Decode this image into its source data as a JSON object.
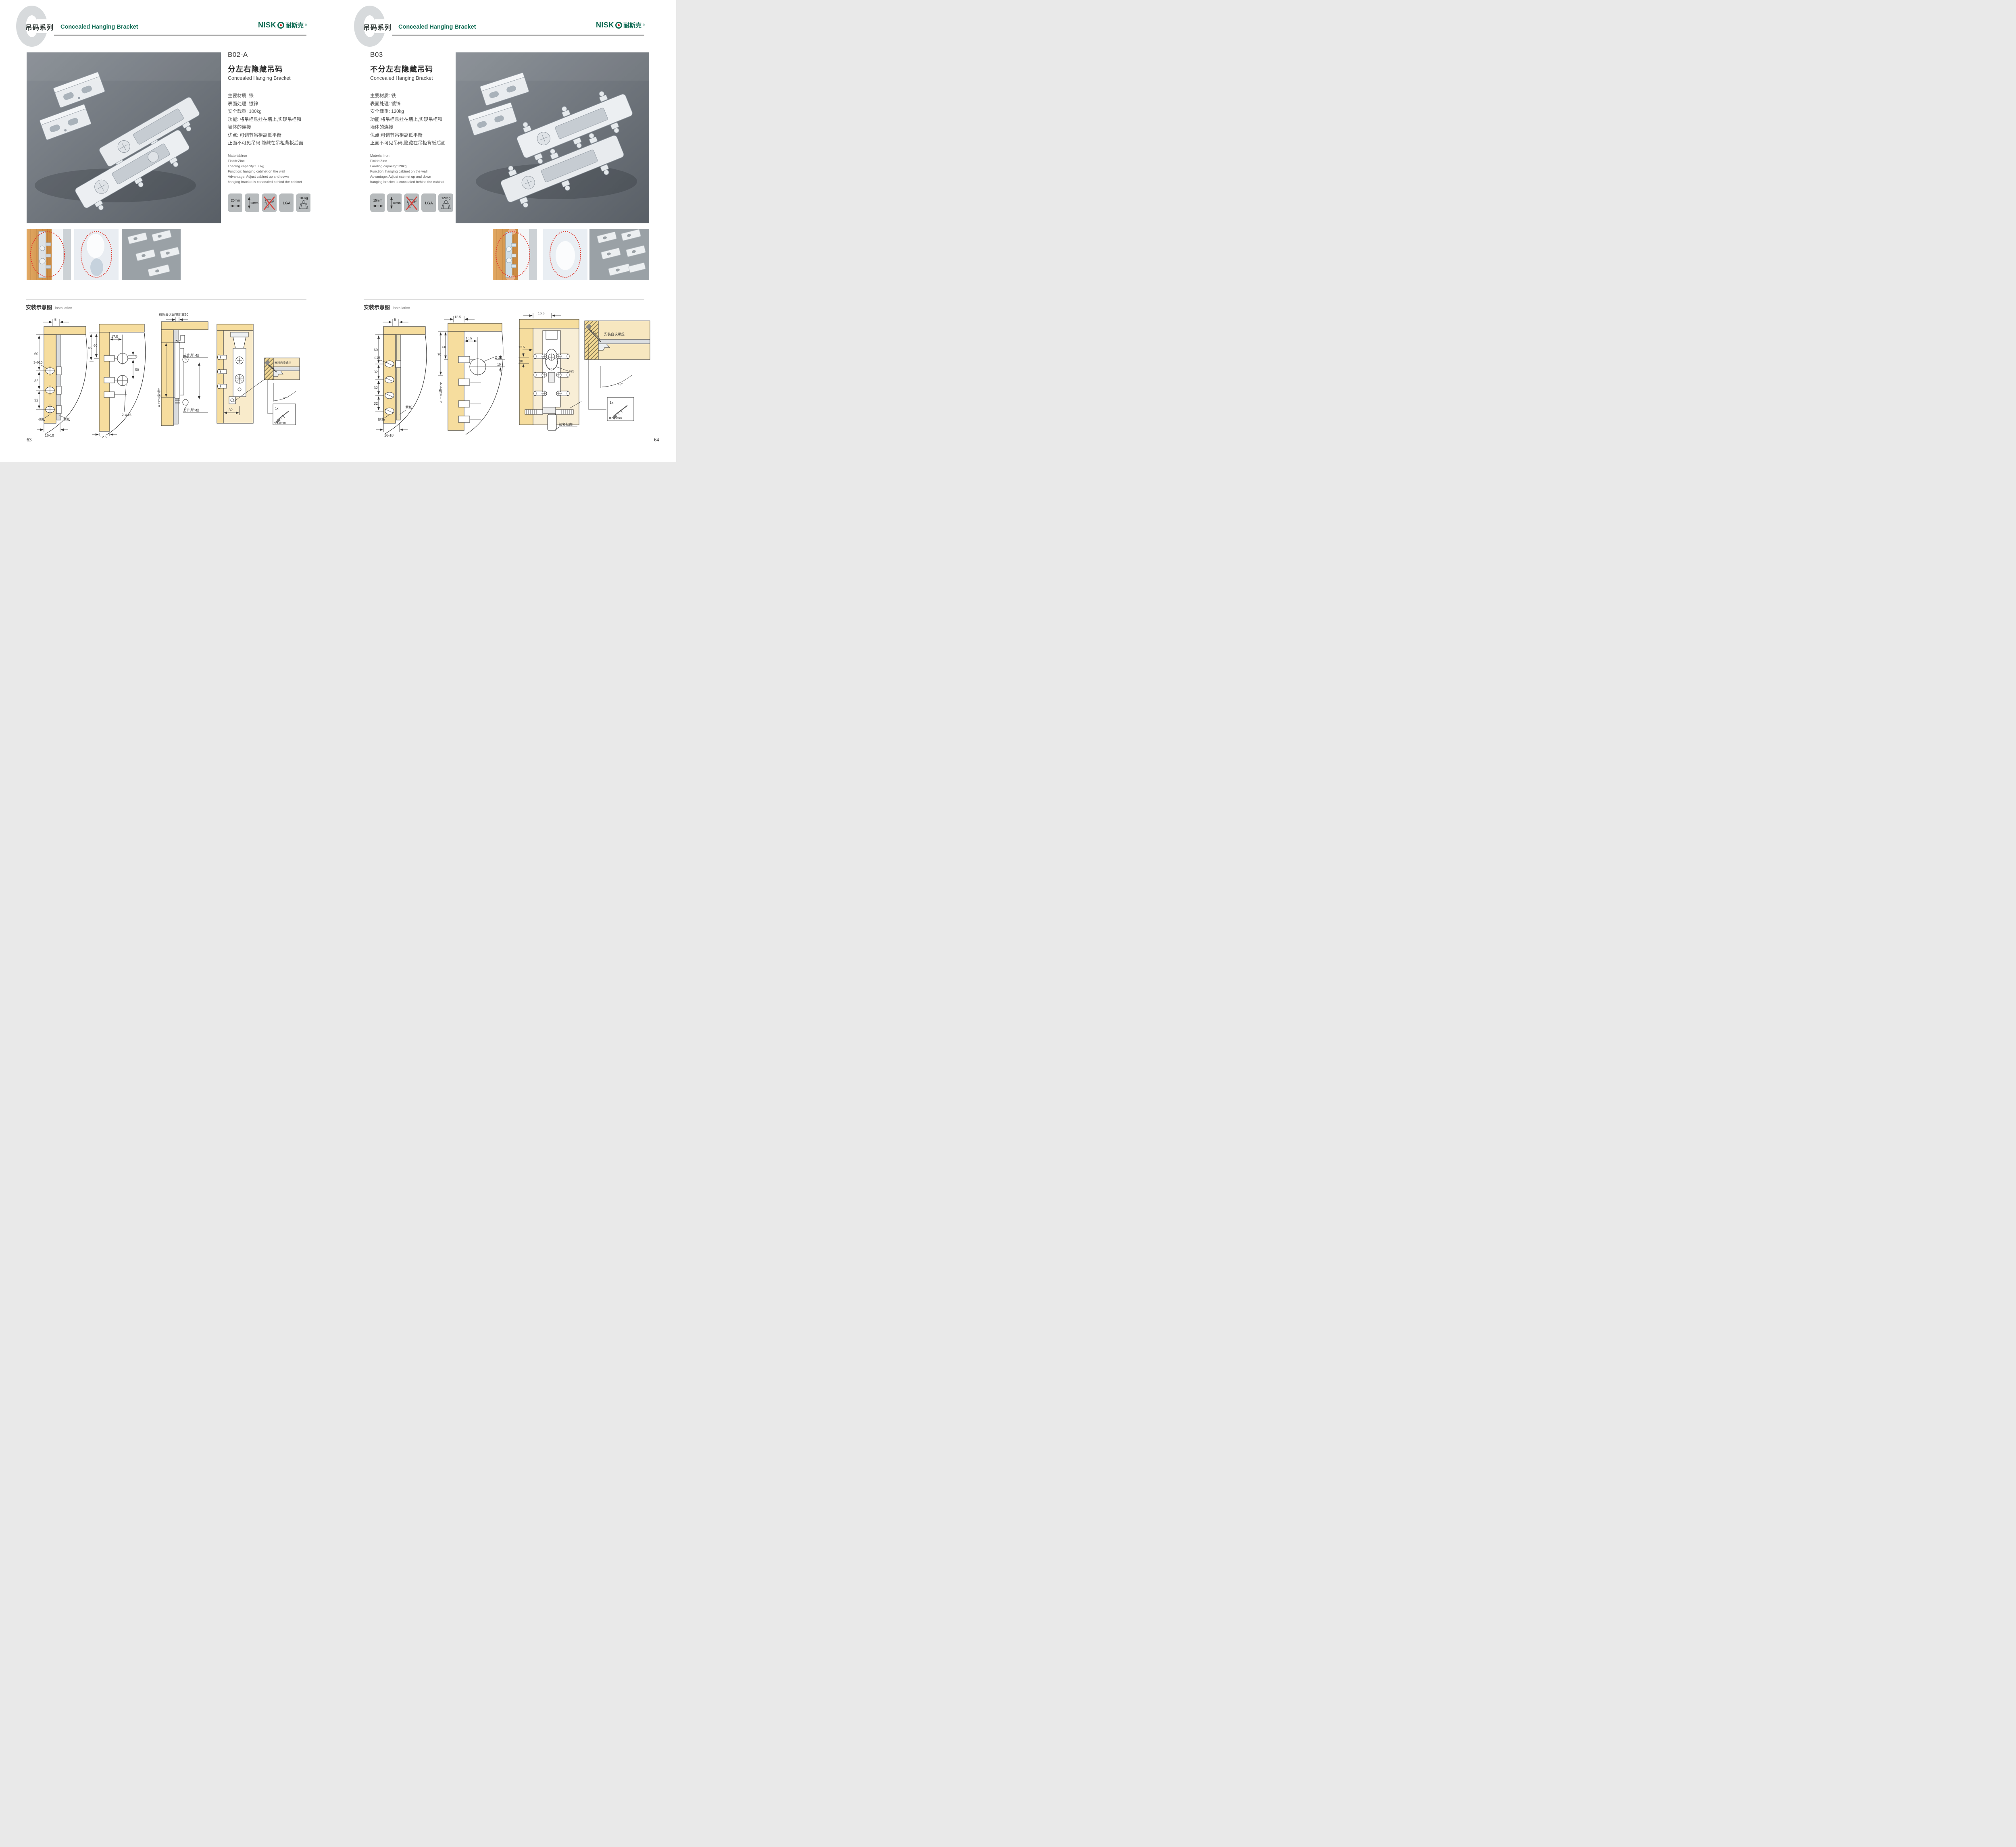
{
  "colors": {
    "accent_green": "#0e6b53",
    "badge_gray": "#b7bbbd",
    "diagram_tan": "#f6dd9e",
    "warn_red": "#d93a33",
    "photo_gray": "#6c7278"
  },
  "brand": {
    "logo_en": "NISK",
    "logo_cn": "耐斯克",
    "reg": "®"
  },
  "header": {
    "series_cn": "吊码系列",
    "series_en": "Concealed Hanging Bracket"
  },
  "install": {
    "title_cn": "安装示意图",
    "title_en": "Installation"
  },
  "left_page": {
    "page_number": "63",
    "product": {
      "code": "B02-A",
      "name_cn": "分左右隐藏吊码",
      "name_en": "Concealed Hanging Bracket",
      "specs_cn": [
        "主要材质: 铁",
        "表面处理: 镀锌",
        "安全载重: 100kg",
        "功能: 将吊柜悬挂在墙上,实现吊柜和",
        "墙体的连接",
        "优点: 可调节吊柜高低平衡",
        "正面不可见吊码,隐藏在吊柜背板后面"
      ],
      "specs_en": [
        "Material:Iron",
        "Finish:Zinc",
        "Loading capacity:100kg",
        "Function: hanging cabinet on the wall",
        "Advantage: Adjust cabinet up and down",
        "hanging bracket is concealed behind the cabinet"
      ],
      "badges": {
        "b1": "20mm",
        "b2": "20mm",
        "b4": "LGA",
        "b5": "100kg"
      }
    },
    "diagrams": {
      "d1": {
        "top": "5",
        "v1": "60",
        "v2": "32",
        "v3": "32",
        "hole": "3-Φ10",
        "side": "侧板",
        "back": "背板",
        "bottom": "16-18"
      },
      "d2": {
        "l1": "65",
        "l2": "60",
        "top": "17.5",
        "gap": "5",
        "mid": "50",
        "hole": "2-Φ15",
        "bottom": "12.5"
      },
      "d3": {
        "top": "前后最大调节距离20",
        "vert": "上下调节20",
        "front": "前后调节位",
        "ud": "上下调节位"
      },
      "d4": {
        "dim": "32",
        "screw": "安装自攻螺丝",
        "angle": "45°",
        "qty": "1x",
        "dia": "Φ3.5mm"
      }
    }
  },
  "right_page": {
    "page_number": "64",
    "product": {
      "code": "B03",
      "name_cn": "不分左右隐藏吊码",
      "name_en": "Concealed Hanging Bracket",
      "specs_cn": [
        "主要材质: 铁",
        "表面处理: 镀锌",
        "安全载重: 120kg",
        "功能:将吊柜悬挂在墙上,实现吊柜和",
        "墙体的连接",
        "优点:可调节吊柜高低平衡",
        "正面不可见吊码,隐藏在吊柜背板后面"
      ],
      "specs_en": [
        "Material:Iron",
        "Finish:Zinc",
        "Loading capacity:120kg",
        "Function: hanging cabinet on the wall",
        "Advantage: Adjust cabinet up and down",
        "hanging bracket is concealed behind the cabinet"
      ],
      "badges": {
        "b1": "15mm",
        "b2": "18mm",
        "b4": "LGA",
        "b5": "120Kg"
      }
    },
    "diagrams": {
      "d1": {
        "top": "5",
        "v1": "60",
        "v2": "32",
        "v3": "32",
        "v4": "32",
        "hole": "Φ10",
        "side": "侧板",
        "back": "背板",
        "bottom": "16-18"
      },
      "d2": {
        "top": "12.5",
        "l1": "70",
        "l2": "60",
        "t2": "16.5",
        "hole": "Ø 25",
        "off": "10",
        "vert": "上下调节18"
      },
      "d3": {
        "top": "16.5",
        "left": "12.5",
        "off": "10",
        "hole": "ø25",
        "lock": "锁紧状态"
      },
      "d4": {
        "screw": "安装自攻螺丝",
        "angle": "45°",
        "qty": "1x",
        "dia": "Φ3.5mm"
      }
    }
  }
}
